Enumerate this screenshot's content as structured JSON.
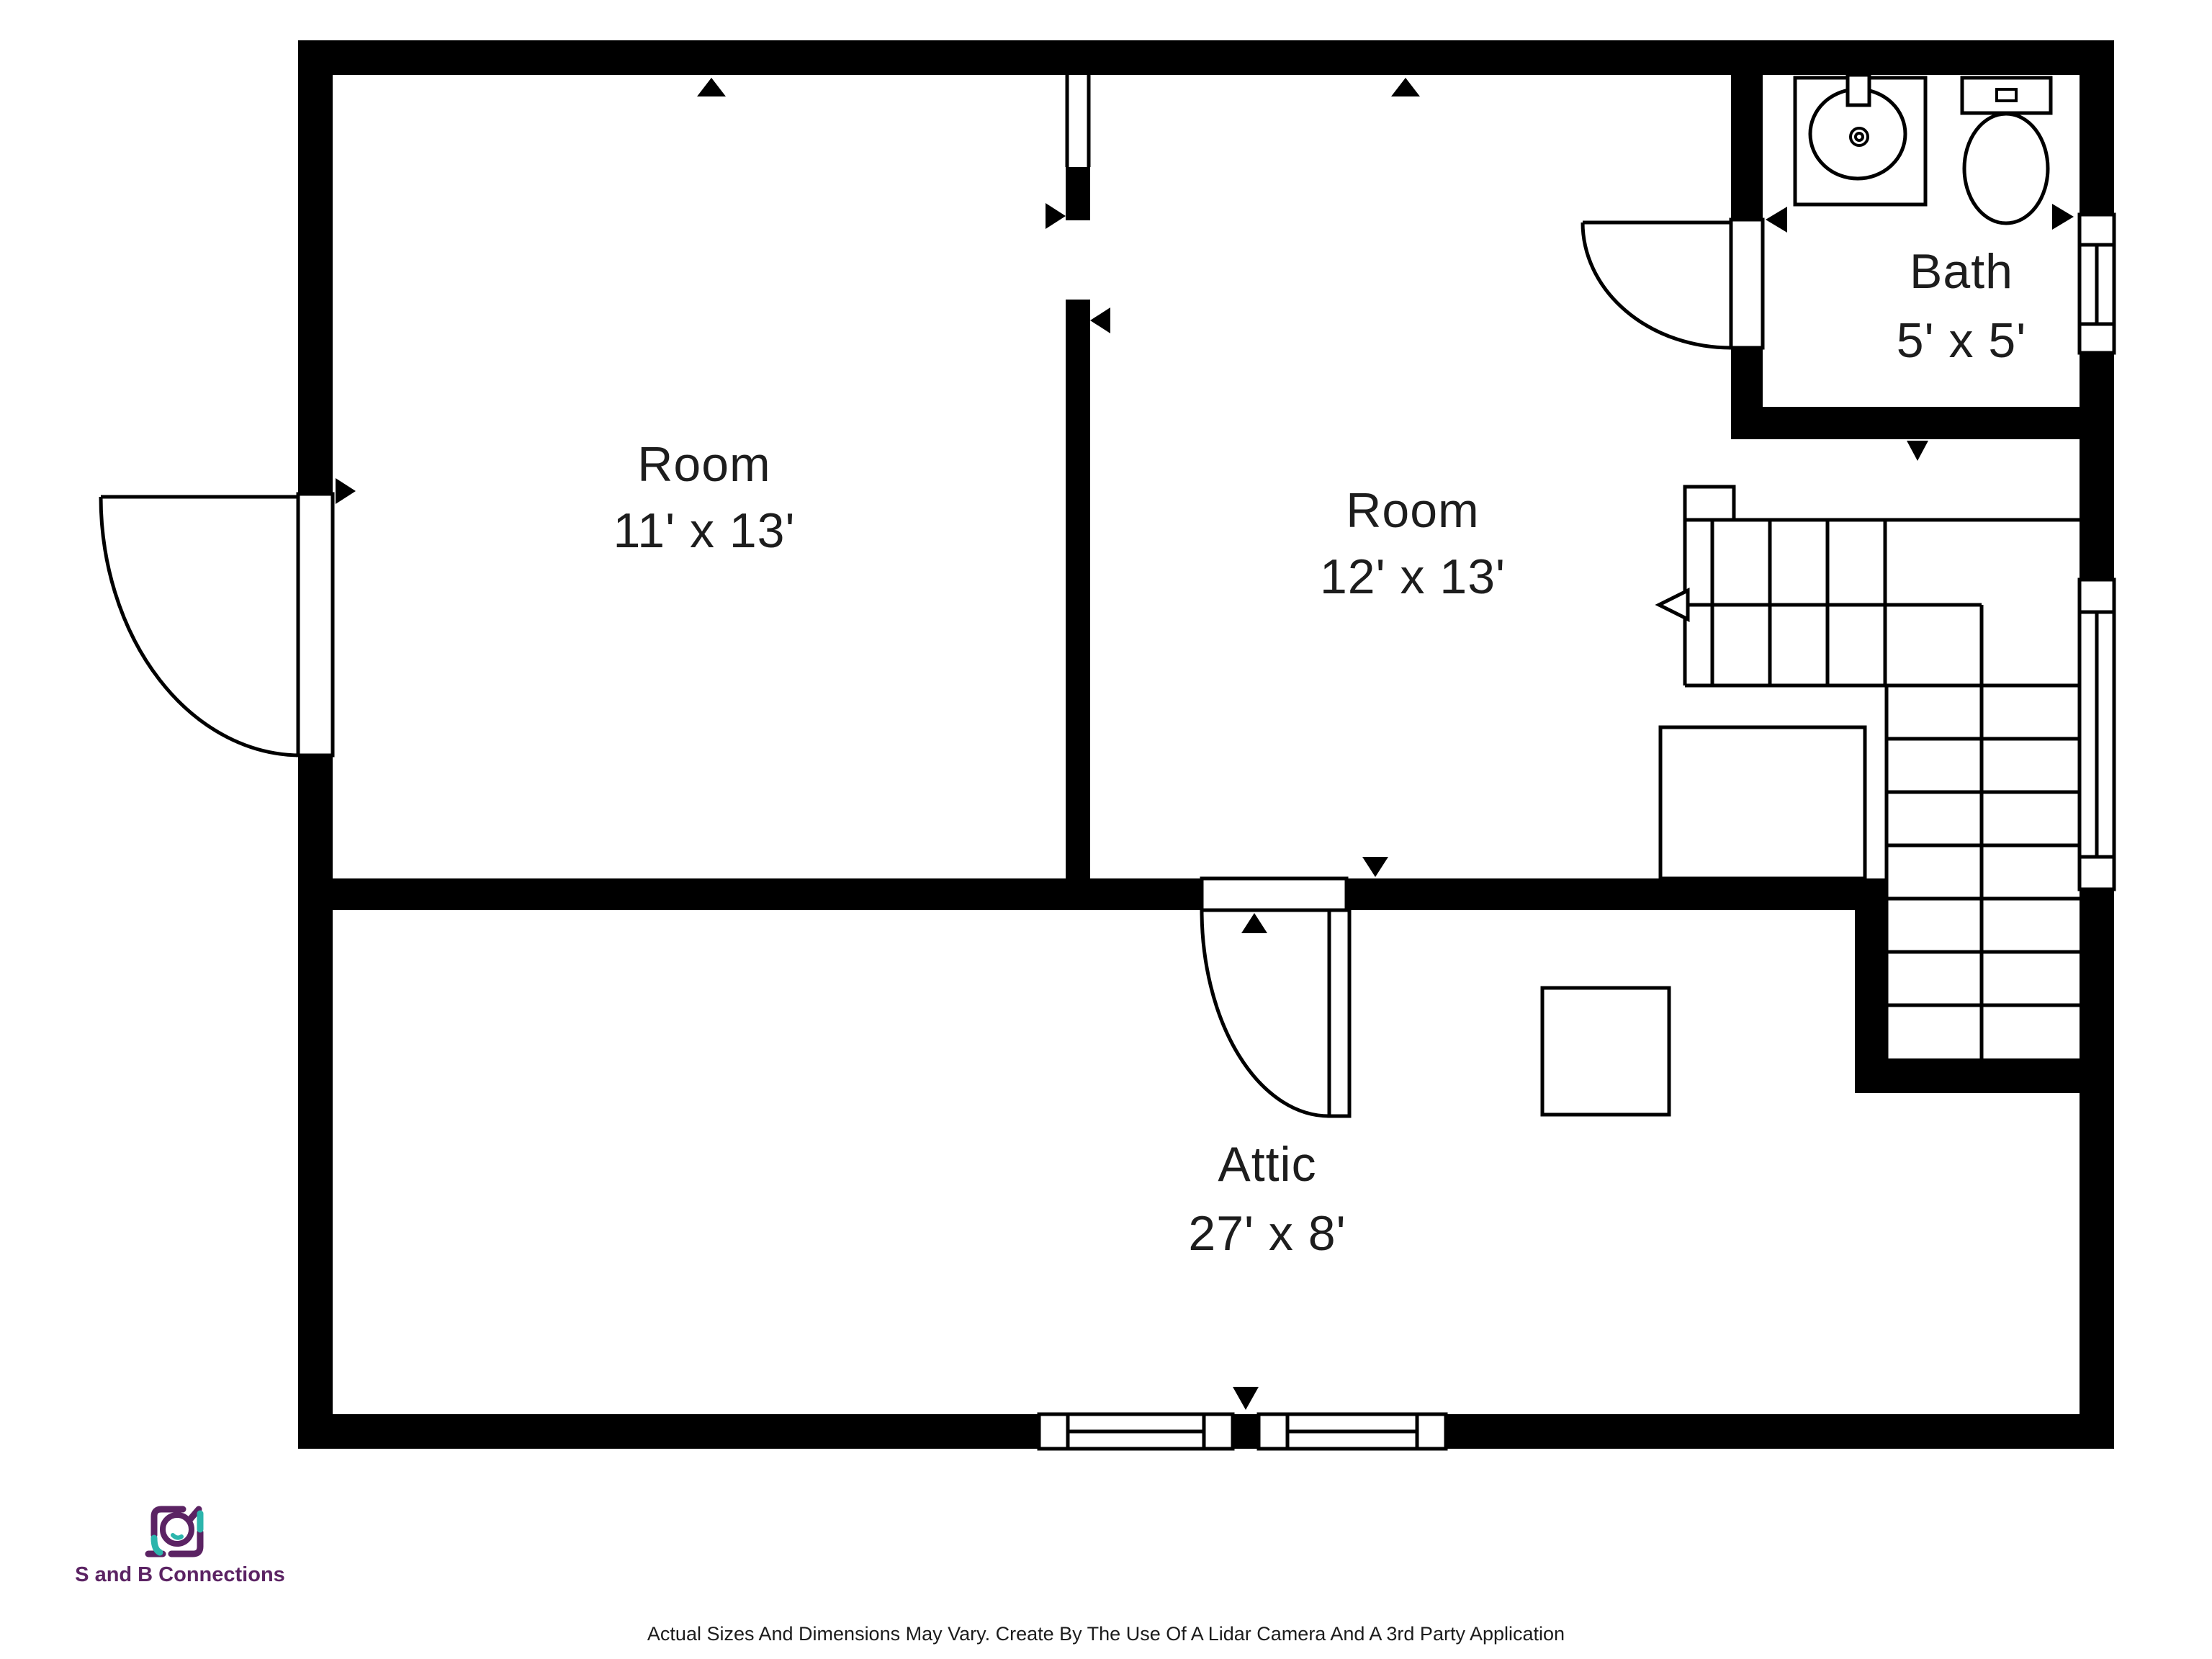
{
  "plan": {
    "rooms": [
      {
        "name": "Room",
        "dims": "11' x 13'"
      },
      {
        "name": "Room",
        "dims": "12' x 13'"
      },
      {
        "name": "Bath",
        "dims": "5' x 5'"
      },
      {
        "name": "Attic",
        "dims": "27' x 8'"
      }
    ]
  },
  "branding": {
    "company": "S and B Connections",
    "purple": "#5b2363",
    "teal": "#2cb5ac"
  },
  "footer": {
    "disclaimer": "Actual Sizes And Dimensions May Vary. Create By The Use Of A Lidar Camera And A 3rd Party Application"
  },
  "colors": {
    "wall": "#000000",
    "label_text": "#1d1d1d",
    "background": "#ffffff"
  }
}
